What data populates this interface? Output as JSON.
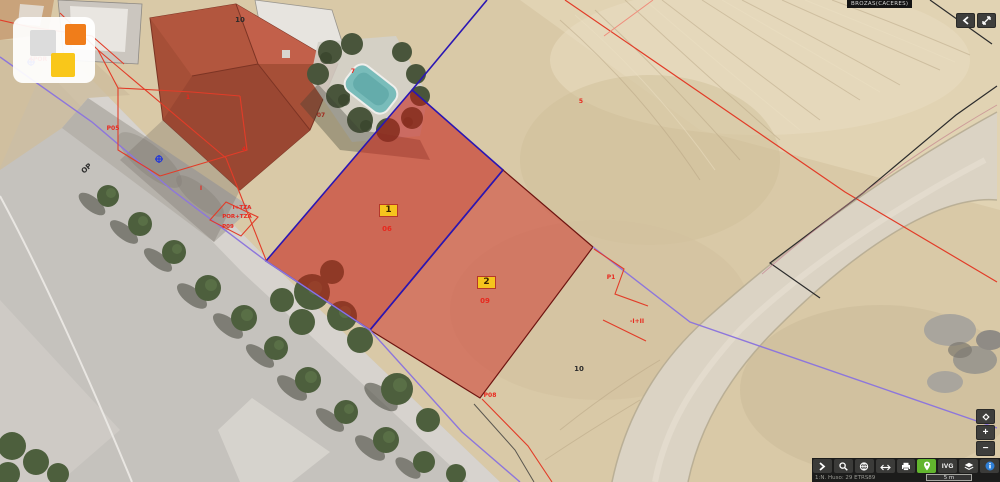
{
  "header": {
    "municipality": "BROZAS(CACERES)"
  },
  "footer": {
    "coords_text": "1:N. Huso: 29 ETRS89",
    "scale_label": "5 m"
  },
  "parcels": [
    {
      "id": "1",
      "sub_label": "06"
    },
    {
      "id": "2",
      "sub_label": "09"
    }
  ],
  "toolbar": {
    "ivg_label": "IVG",
    "buttons": [
      {
        "name": "expand-tools-button",
        "icon": "chevron-right-icon"
      },
      {
        "name": "zoom-search-button",
        "icon": "magnifier-icon"
      },
      {
        "name": "ortophoto-button",
        "icon": "globe-icon"
      },
      {
        "name": "measure-button",
        "icon": "left-right-arrow-icon"
      },
      {
        "name": "print-button",
        "icon": "printer-icon"
      },
      {
        "name": "pin-tool-button",
        "icon": "map-pin-icon",
        "active": true,
        "active_color": "#62b52e"
      },
      {
        "name": "ivg-button",
        "icon": "text-IVG"
      },
      {
        "name": "cartography-layers-button",
        "icon": "layers-icon"
      },
      {
        "name": "info-button",
        "icon": "info-circle-icon",
        "icon_color": "#2f7fd6"
      }
    ]
  },
  "top_right_buttons": [
    {
      "name": "collapse-panel-button",
      "icon": "chevron-left-icon"
    },
    {
      "name": "fullscreen-button",
      "icon": "expand-arrows-icon"
    }
  ],
  "zoom_stack": [
    {
      "name": "recenter-button",
      "icon": "diamond-icon"
    },
    {
      "name": "zoom-in-button",
      "label": "+"
    },
    {
      "name": "zoom-out-button",
      "label": "−"
    }
  ],
  "colors": {
    "highlight_fill_1": "rgba(197,28,22,0.56)",
    "highlight_fill_2": "rgba(205,45,38,0.50)",
    "selection_blue": "#2a16b4",
    "boundary_purple": "#8d76dc",
    "cadastral_red": "#e23c28",
    "marker_yellow": "#f6c51d",
    "active_green": "#62b52e",
    "info_blue": "#2f7fd6",
    "label_palette": {
      "red": "#e8281e",
      "darkred": "#a02a1e",
      "black": "#2b2b2b"
    }
  },
  "map_labels": [
    {
      "text": "4POR",
      "x": 38,
      "y": 61,
      "color": "red",
      "size": 6
    },
    {
      "text": "P05",
      "x": 113,
      "y": 130,
      "color": "red",
      "size": 6
    },
    {
      "text": "1",
      "x": 188,
      "y": 99,
      "color": "red",
      "size": 6
    },
    {
      "text": "10",
      "x": 240,
      "y": 22,
      "color": "black",
      "size": 7
    },
    {
      "text": "07",
      "x": 321,
      "y": 117,
      "color": "darkred",
      "size": 6
    },
    {
      "text": "4",
      "x": 244,
      "y": 151,
      "color": "red",
      "size": 6
    },
    {
      "text": "I",
      "x": 201,
      "y": 190,
      "color": "red",
      "size": 6
    },
    {
      "text": "I+TZA",
      "x": 242,
      "y": 209,
      "color": "red",
      "size": 5.5
    },
    {
      "text": "POR+TZA",
      "x": 237,
      "y": 218,
      "color": "red",
      "size": 5.5
    },
    {
      "text": "P09",
      "x": 228,
      "y": 228,
      "color": "red",
      "size": 5.5
    },
    {
      "text": "OP",
      "x": 88,
      "y": 170,
      "color": "black",
      "size": 7,
      "rotate": -42
    },
    {
      "text": "7",
      "x": 353,
      "y": 73,
      "color": "red",
      "size": 6
    },
    {
      "text": "5",
      "x": 581,
      "y": 103,
      "color": "red",
      "size": 6
    },
    {
      "text": "06",
      "x": 387,
      "y": 231,
      "color": "red",
      "size": 7
    },
    {
      "text": "09",
      "x": 485,
      "y": 303,
      "color": "red",
      "size": 7
    },
    {
      "text": "P1",
      "x": 611,
      "y": 279,
      "color": "red",
      "size": 6
    },
    {
      "text": "-I+II",
      "x": 637,
      "y": 323,
      "color": "red",
      "size": 6
    },
    {
      "text": "10",
      "x": 579,
      "y": 371,
      "color": "black",
      "size": 7
    },
    {
      "text": "P08",
      "x": 490,
      "y": 397,
      "color": "red",
      "size": 6
    }
  ]
}
